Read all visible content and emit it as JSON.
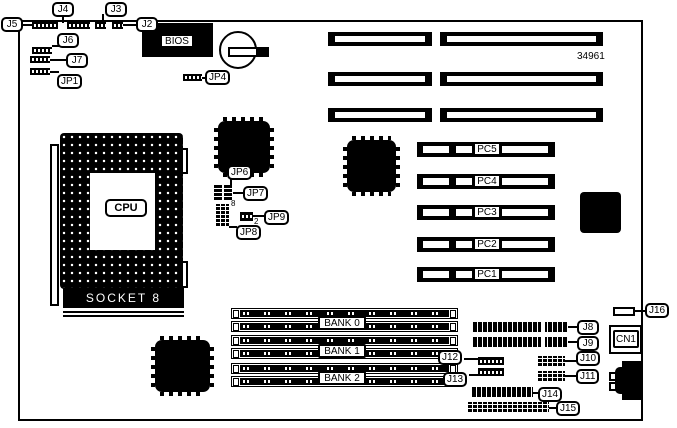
{
  "board": {
    "part_number": "34961"
  },
  "callouts": {
    "j2": "J2",
    "j3": "J3",
    "j4": "J4",
    "j5": "J5",
    "j6": "J6",
    "j7": "J7",
    "jp1": "JP1",
    "jp4": "JP4",
    "jp6": "JP6",
    "jp7": "JP7",
    "jp8": "JP8",
    "jp9": "JP9",
    "j8": "J8",
    "j9": "J9",
    "j10": "J10",
    "j11": "J11",
    "j12": "J12",
    "j13": "J13",
    "j14": "J14",
    "j15": "J15",
    "j16": "J16",
    "cn1": "CN1"
  },
  "chips": {
    "bios": "BIOS",
    "cpu": "CPU",
    "socket": "SOCKET 8"
  },
  "slots": {
    "pci": [
      "PC5",
      "PC4",
      "PC3",
      "PC2",
      "PC1"
    ],
    "banks": [
      "BANK 0",
      "BANK 1",
      "BANK 2"
    ]
  },
  "pins": {
    "jp8_top": "8",
    "jp9_right": "2"
  },
  "colors": {
    "fg": "#000000",
    "bg": "#ffffff"
  }
}
